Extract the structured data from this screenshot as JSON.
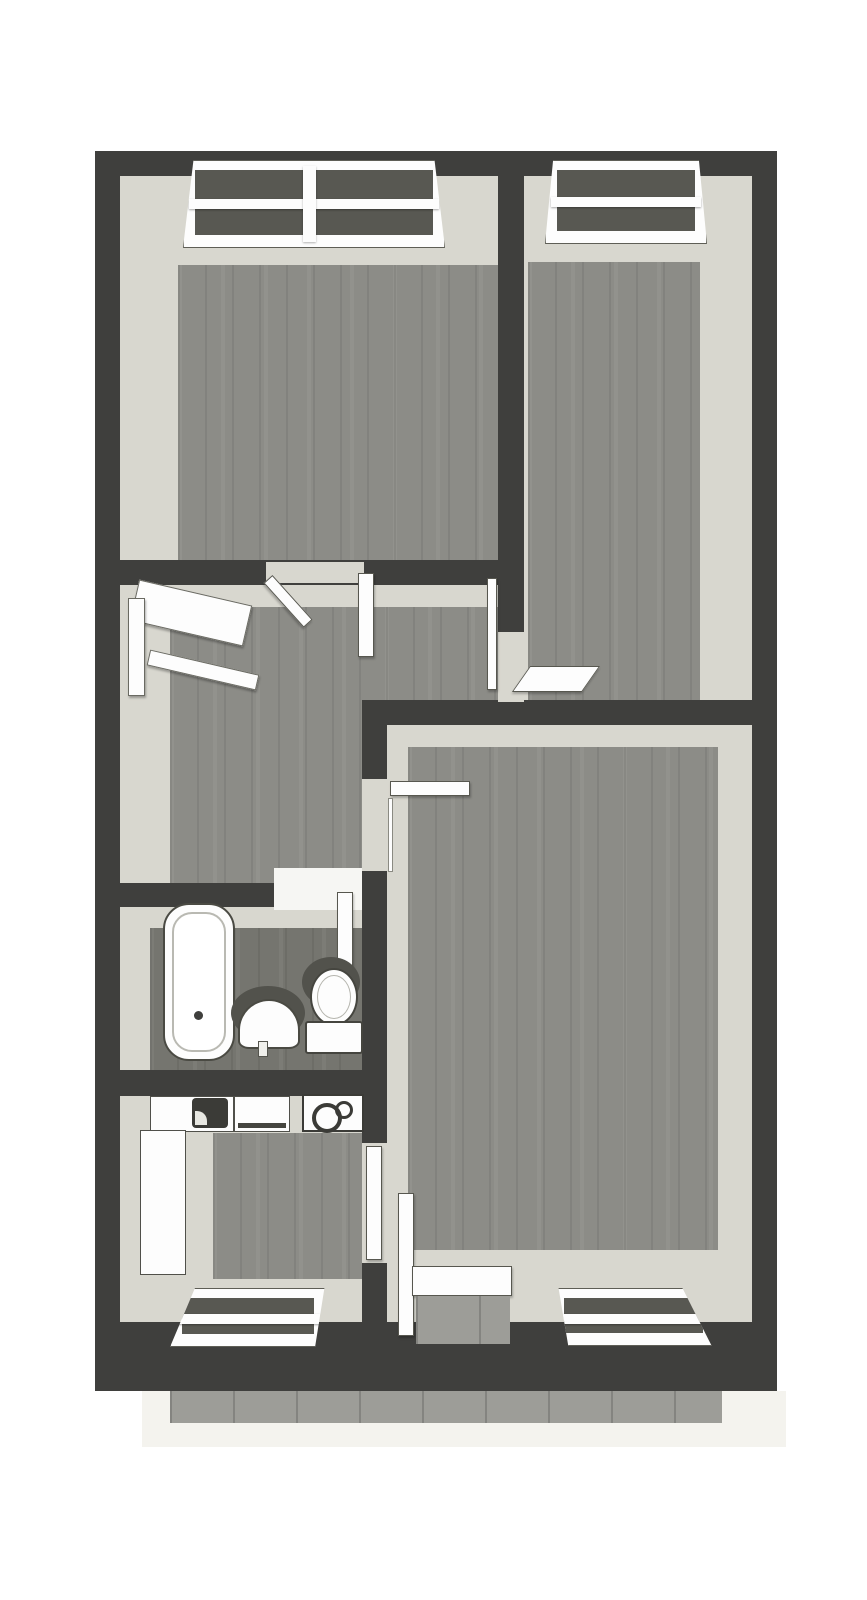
{
  "scene": {
    "wall": "#3f3f3d",
    "face": "#d8d7cf",
    "wood": "#8c8c87",
    "wood_dark": "#75756f",
    "tile": "#9d9d98",
    "apron": "#f4f3ee",
    "white": "#fdfdfd"
  },
  "plan": {
    "width": 867,
    "height": 1600,
    "rooms": [
      {
        "id": "bedroom-top-left"
      },
      {
        "id": "bedroom-top-right"
      },
      {
        "id": "hallway"
      },
      {
        "id": "bathroom"
      },
      {
        "id": "kitchen"
      },
      {
        "id": "living-room"
      },
      {
        "id": "balcony"
      }
    ]
  },
  "elements": [
    {
      "name": "balcony-apron",
      "cls": "apron",
      "x": 142,
      "y": 1391,
      "w": 644,
      "h": 56
    },
    {
      "name": "balcony-tiles",
      "cls": "tiles",
      "x": 170,
      "y": 1391,
      "w": 552,
      "h": 32
    },
    {
      "name": "bedroom-top-left-walls-face",
      "cls": "face",
      "x": 120,
      "y": 176,
      "w": 378,
      "h": 384
    },
    {
      "name": "bedroom-top-right-walls-face",
      "cls": "face",
      "x": 524,
      "y": 176,
      "w": 228,
      "h": 549
    },
    {
      "name": "hallway-walls-face-upper",
      "cls": "face",
      "x": 120,
      "y": 585,
      "w": 378,
      "h": 140
    },
    {
      "name": "hallway-walls-face-lower",
      "cls": "face",
      "x": 120,
      "y": 725,
      "w": 242,
      "h": 158
    },
    {
      "name": "bathroom-walls-face",
      "cls": "face",
      "x": 120,
      "y": 907,
      "w": 242,
      "h": 163
    },
    {
      "name": "kitchen-walls-face",
      "cls": "face",
      "x": 120,
      "y": 1096,
      "w": 242,
      "h": 226
    },
    {
      "name": "living-room-walls-face",
      "cls": "face",
      "x": 387,
      "y": 725,
      "w": 365,
      "h": 597
    },
    {
      "name": "bedroom-top-left-floor",
      "cls": "wood",
      "x": 178,
      "y": 265,
      "w": 320,
      "h": 295
    },
    {
      "name": "bedroom-top-right-floor",
      "cls": "wood",
      "x": 528,
      "y": 262,
      "w": 172,
      "h": 463
    },
    {
      "name": "hallway-floor-upper",
      "cls": "wood",
      "x": 170,
      "y": 607,
      "w": 328,
      "h": 118
    },
    {
      "name": "hallway-floor-lower",
      "cls": "wood",
      "x": 170,
      "y": 725,
      "w": 192,
      "h": 158
    },
    {
      "name": "bathroom-floor",
      "cls": "wood dark",
      "x": 150,
      "y": 928,
      "w": 212,
      "h": 142
    },
    {
      "name": "kitchen-floor",
      "cls": "wood",
      "x": 213,
      "y": 1133,
      "w": 149,
      "h": 146
    },
    {
      "name": "living-room-floor",
      "cls": "wood",
      "x": 408,
      "y": 747,
      "w": 310,
      "h": 503
    },
    {
      "name": "wall-exterior-top",
      "cls": "wall",
      "x": 95,
      "y": 151,
      "w": 682,
      "h": 25
    },
    {
      "name": "wall-exterior-left",
      "cls": "wall",
      "x": 95,
      "y": 151,
      "w": 25,
      "h": 1240
    },
    {
      "name": "wall-exterior-right",
      "cls": "wall",
      "x": 752,
      "y": 151,
      "w": 25,
      "h": 1240
    },
    {
      "name": "wall-exterior-bottom",
      "cls": "wall",
      "x": 95,
      "y": 1322,
      "w": 682,
      "h": 69
    },
    {
      "name": "wall-divider-bedrooms",
      "cls": "wall",
      "x": 498,
      "y": 151,
      "w": 26,
      "h": 574
    },
    {
      "name": "wall-hallway-top",
      "cls": "wall",
      "x": 95,
      "y": 560,
      "w": 429,
      "h": 25
    },
    {
      "name": "wall-living-room-top",
      "cls": "wall",
      "x": 362,
      "y": 700,
      "w": 415,
      "h": 25
    },
    {
      "name": "wall-living-room-left",
      "cls": "wall",
      "x": 362,
      "y": 700,
      "w": 25,
      "h": 691
    },
    {
      "name": "wall-bathroom-top",
      "cls": "wall",
      "x": 95,
      "y": 883,
      "w": 292,
      "h": 24
    },
    {
      "name": "wall-kitchen-top",
      "cls": "wall",
      "x": 95,
      "y": 1070,
      "w": 292,
      "h": 26
    },
    {
      "name": "doorway-hall-to-bedroom-left",
      "cls": "gap",
      "x": 266,
      "y": 562,
      "w": 98,
      "h": 21
    },
    {
      "name": "doorway-hall-to-bedroom-right",
      "cls": "gap",
      "x": 498,
      "y": 632,
      "w": 26,
      "h": 70
    },
    {
      "name": "doorway-hall-to-bathroom",
      "cls": "gapw",
      "x": 274,
      "y": 868,
      "w": 88,
      "h": 42
    },
    {
      "name": "doorway-hall-to-living-room",
      "cls": "gap",
      "x": 362,
      "y": 779,
      "w": 25,
      "h": 92
    },
    {
      "name": "doorway-kitchen-to-living-room",
      "cls": "gap",
      "x": 362,
      "y": 1143,
      "w": 25,
      "h": 120
    },
    {
      "name": "window-bedroom-left",
      "cls": "window",
      "x": 183,
      "y": 160,
      "w": 262,
      "h": 88,
      "clip": "polygon(4% 0, 96% 0, 100% 100%, 0 100%)"
    },
    {
      "name": "window-bedroom-left-mullion",
      "cls": "winbar",
      "x": 303,
      "y": 166,
      "w": 13,
      "h": 76
    },
    {
      "name": "window-bedroom-right",
      "cls": "window",
      "x": 545,
      "y": 160,
      "w": 162,
      "h": 84,
      "clip": "polygon(5% 0, 95% 0, 100% 100%, 0 100%)"
    },
    {
      "name": "window-kitchen",
      "cls": "window",
      "x": 170,
      "y": 1288,
      "w": 156,
      "h": 59,
      "clip": "polygon(16% 0, 99% 0, 93% 100%, 0 100%)"
    },
    {
      "name": "window-living-room",
      "cls": "window",
      "x": 552,
      "y": 1288,
      "w": 163,
      "h": 58,
      "clip": "polygon(4% 0, 80% 0, 98% 100%, 10% 100%)"
    },
    {
      "name": "window-hallway-canopy",
      "cls": "hallwin",
      "x": 133,
      "y": 592,
      "w": 116,
      "h": 42,
      "rot": 13
    },
    {
      "name": "window-hallway-jamb",
      "cls": "hallwin",
      "x": 128,
      "y": 598,
      "w": 17,
      "h": 98
    },
    {
      "name": "window-hallway-sill",
      "cls": "hallwin",
      "x": 147,
      "y": 662,
      "w": 112,
      "h": 16,
      "rot": 13
    },
    {
      "name": "door-bedroom-left-panel",
      "cls": "door",
      "x": 268,
      "y": 573,
      "w": 60,
      "h": 12,
      "rot": 48,
      "origin": "left center"
    },
    {
      "name": "door-bedroom-left-panel-open",
      "cls": "door",
      "x": 358,
      "y": 573,
      "w": 16,
      "h": 84
    },
    {
      "name": "door-bedroom-right-frame",
      "cls": "door",
      "x": 487,
      "y": 578,
      "w": 10,
      "h": 112
    },
    {
      "name": "door-bedroom-right-panel",
      "cls": "door",
      "x": 521,
      "y": 666,
      "w": 70,
      "h": 26,
      "skewx": -35
    },
    {
      "name": "door-living-room-panel",
      "cls": "door",
      "x": 390,
      "y": 781,
      "w": 80,
      "h": 15
    },
    {
      "name": "door-living-room-frame",
      "cls": "doorline",
      "x": 388,
      "y": 798,
      "w": 5,
      "h": 74
    },
    {
      "name": "door-bathroom-panel",
      "cls": "door",
      "x": 337,
      "y": 892,
      "w": 16,
      "h": 82
    },
    {
      "name": "door-kitchen-panel",
      "cls": "door",
      "x": 366,
      "y": 1146,
      "w": 16,
      "h": 114
    },
    {
      "name": "door-balcony-panel",
      "cls": "door",
      "x": 398,
      "y": 1193,
      "w": 16,
      "h": 143
    },
    {
      "name": "door-balcony-threshold",
      "cls": "door",
      "x": 412,
      "y": 1266,
      "w": 100,
      "h": 30
    },
    {
      "name": "door-balcony-tiles",
      "cls": "tiles",
      "x": 416,
      "y": 1296,
      "w": 94,
      "h": 48
    },
    {
      "name": "bathtub",
      "cls": "tub",
      "x": 163,
      "y": 903,
      "w": 72,
      "h": 158
    },
    {
      "name": "sink-shadow",
      "cls": "blob",
      "x": 231,
      "y": 986,
      "w": 74,
      "h": 54
    },
    {
      "name": "pedestal-sink",
      "cls": "sink",
      "x": 238,
      "y": 999,
      "w": 62,
      "h": 50
    },
    {
      "name": "sink-tap",
      "cls": "tap",
      "x": 258,
      "y": 1041,
      "w": 10,
      "h": 16
    },
    {
      "name": "toilet-shadow",
      "cls": "blob",
      "x": 302,
      "y": 957,
      "w": 58,
      "h": 50
    },
    {
      "name": "toilet-bowl",
      "cls": "bowl",
      "x": 310,
      "y": 968,
      "w": 48,
      "h": 58
    },
    {
      "name": "toilet-cistern",
      "cls": "cistern",
      "x": 305,
      "y": 1021,
      "w": 58,
      "h": 33
    },
    {
      "name": "kitchen-counter-top",
      "cls": "counter",
      "x": 150,
      "y": 1096,
      "w": 84,
      "h": 36
    },
    {
      "name": "kitchen-sink-basin",
      "cls": "basin",
      "x": 192,
      "y": 1098,
      "w": 36,
      "h": 30
    },
    {
      "name": "kitchen-counter-mid",
      "cls": "counter mid",
      "x": 234,
      "y": 1096,
      "w": 56,
      "h": 36
    },
    {
      "name": "kitchen-stove",
      "cls": "stove",
      "x": 302,
      "y": 1094,
      "w": 62,
      "h": 38
    },
    {
      "name": "kitchen-counter-left",
      "cls": "counter",
      "x": 140,
      "y": 1130,
      "w": 46,
      "h": 145
    }
  ]
}
